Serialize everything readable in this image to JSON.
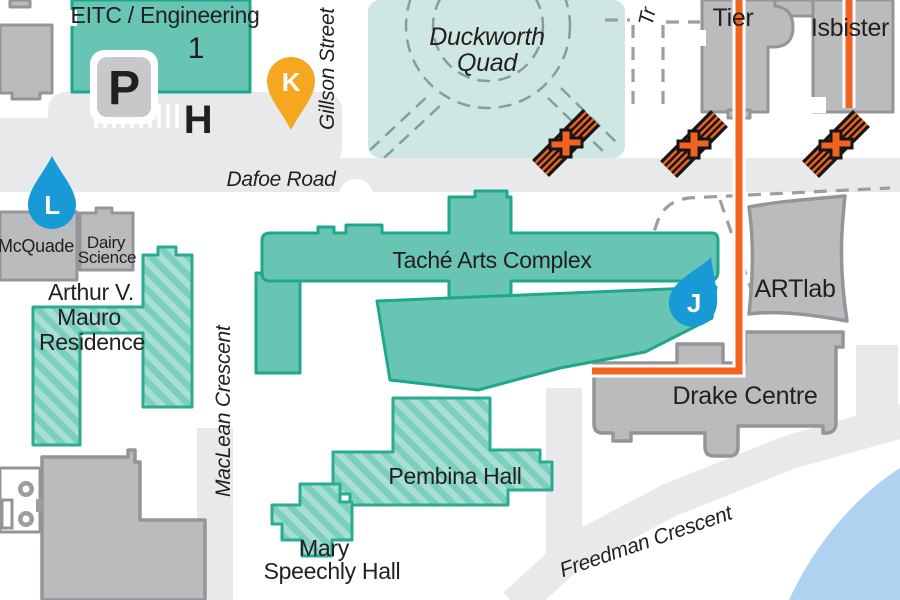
{
  "streets": {
    "gillson": "Gillson Street",
    "dafoe": "Dafoe Road",
    "maclean": "MacLean Crescent",
    "freedman": "Freedman Crescent",
    "partial_top": "Tr"
  },
  "areas": {
    "duckworth": [
      "Duckworth",
      "Quad"
    ]
  },
  "buildings": {
    "eitc": [
      "EITC / Engineering",
      "1"
    ],
    "tier": "Tier",
    "isbister": "Isbister",
    "mcquade": "McQuade",
    "dairy": [
      "Dairy",
      "Science"
    ],
    "mauro": [
      "Arthur V.",
      "Mauro",
      "Residence"
    ],
    "tache": "Taché Arts Complex",
    "artlab": "ARTlab",
    "drake": "Drake Centre",
    "pembina": "Pembina Hall",
    "mary": [
      "Mary",
      "Speechly Hall"
    ]
  },
  "markers": {
    "pin_k": "K",
    "pin_l": "L",
    "pin_j": "J",
    "parking": "P",
    "h_symbol": "H"
  },
  "colors": {
    "teal_building_fill": "#68c5b3",
    "teal_building_stroke": "#1fa78c",
    "hatch_light": "#a8ded4",
    "hatch_dark": "#7bcfbd",
    "quad_fill": "#cfe7e2",
    "gray_building_fill": "#b9bbbd",
    "gray_building_stroke": "#939598",
    "road_gray": "#e8e9ea",
    "route_orange": "#f26322",
    "marker_blue": "#189ad6",
    "marker_yellow": "#f4a71f",
    "water_blue": "#aed2f0",
    "label_text": "#231f20"
  }
}
